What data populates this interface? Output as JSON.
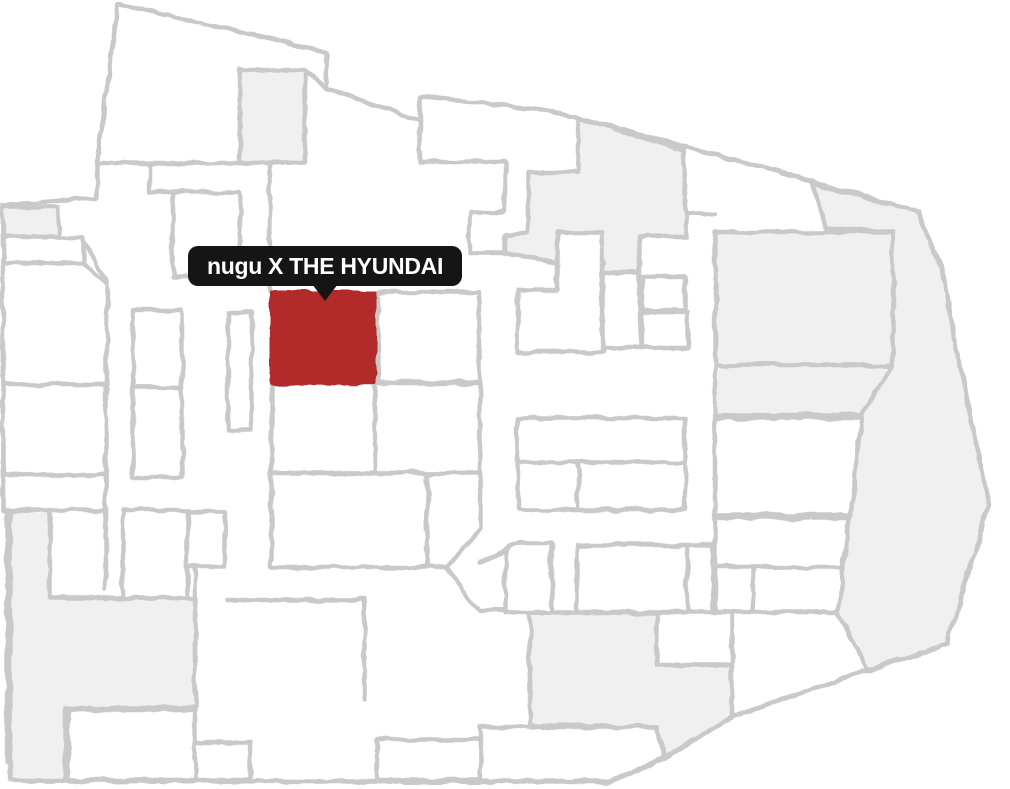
{
  "app": {
    "type": "indoor-floor-map",
    "description": "Department store floor map with one highlighted store"
  },
  "tooltip": {
    "label": "nugu X THE HYUNDAI",
    "bg": "#151515",
    "text_color": "#ffffff",
    "x": 188,
    "y": 246,
    "width": 274,
    "height": 40,
    "pointer_offset_x": 124
  },
  "colors": {
    "wall": "#c9c9c9",
    "room_fill": "#ffffff",
    "shaded_fill": "#f0f0f0",
    "highlight_fill": "#b22b2b",
    "background": "#ffffff"
  },
  "map": {
    "width": 1010,
    "height": 789,
    "stroke_width": 4.5,
    "highlight_room": {
      "label": "nugu X THE HYUNDAI",
      "x": 271,
      "y": 292,
      "width": 104,
      "height": 91
    },
    "shapes": [
      {
        "name": "outer-boundary",
        "kind": "boundary",
        "closed": true,
        "pts": "118,4 327,52 326,88 420,121 420,96 547,110 810,180 918,212 941,269 957,352 989,505 947,644 867,670 732,717 665,758 610,782 30,781 7,762 7,512 3,498 3,205 97,198 97,163"
      },
      {
        "name": "shaded-top-square",
        "kind": "shaded",
        "closed": true,
        "pts": "240,70 305,70 305,163 240,163"
      },
      {
        "name": "wall-top-connector",
        "kind": "wall",
        "closed": false,
        "pts": "305,70 325,87"
      },
      {
        "name": "shaded-left-small",
        "kind": "shaded",
        "closed": true,
        "pts": "3,207 58,207 58,237 3,237"
      },
      {
        "name": "shaded-top-middle",
        "kind": "shaded",
        "closed": true,
        "pts": "578,118 683,150 687,237 640,237 640,273 603,273 505,253 505,235 528,230 528,172 578,172"
      },
      {
        "name": "shaded-right-large",
        "kind": "shaded",
        "closed": true,
        "pts": "715,232 893,232 893,365 715,365"
      },
      {
        "name": "shaded-right-band",
        "kind": "shaded",
        "closed": true,
        "pts": "715,365 893,365 862,415 715,415"
      },
      {
        "name": "shaded-right-wing",
        "kind": "shaded",
        "closed": true,
        "pts": "812,183 918,212 941,269 957,352 989,505 947,644 867,670 838,613 845,520 862,415 893,365 893,232 826,228"
      },
      {
        "name": "shaded-bottom-left",
        "kind": "shaded",
        "closed": true,
        "pts": "10,510 50,510 50,598 195,598 195,708 65,708 65,781 10,781"
      },
      {
        "name": "shaded-bottom-middle",
        "kind": "shaded",
        "closed": true,
        "pts": "530,613 657,613 657,665 732,665 732,717 665,757 657,727 530,725"
      },
      {
        "name": "room-bottom-left-inner",
        "kind": "room",
        "closed": true,
        "pts": "68,710 195,710 195,780 68,780"
      },
      {
        "name": "room-bottom-left-small",
        "kind": "room",
        "closed": true,
        "pts": "195,742 250,742 250,780 195,780"
      },
      {
        "name": "room-center-l-shape",
        "kind": "room",
        "closed": true,
        "pts": "557,232 602,232 602,352 518,352 518,290 557,290"
      },
      {
        "name": "room-center-a",
        "kind": "room",
        "closed": true,
        "pts": "603,273 640,273 640,348 603,348"
      },
      {
        "name": "room-center-b",
        "kind": "room",
        "closed": true,
        "pts": "642,277 685,277 685,310 642,310"
      },
      {
        "name": "room-center-c",
        "kind": "room",
        "closed": true,
        "pts": "642,312 688,312 688,348 642,348"
      },
      {
        "name": "room-left-a",
        "kind": "room",
        "closed": true,
        "pts": "3,237 83,237 83,263 3,263"
      },
      {
        "name": "wall-left-funnel",
        "kind": "wall",
        "closed": false,
        "pts": "83,240 107,282"
      },
      {
        "name": "room-left-b",
        "kind": "room",
        "closed": true,
        "pts": "3,263 83,263 107,285 107,385 3,385"
      },
      {
        "name": "room-left-c",
        "kind": "room",
        "closed": true,
        "pts": "3,385 106,385 106,475 3,475"
      },
      {
        "name": "room-left-d",
        "kind": "room",
        "closed": true,
        "pts": "3,475 106,475 106,510 3,510"
      },
      {
        "name": "wall-left-corridor",
        "kind": "wall",
        "closed": false,
        "pts": "106,475 106,590"
      },
      {
        "name": "room-narrow-a",
        "kind": "room",
        "closed": true,
        "pts": "133,310 182,310 182,388 133,388"
      },
      {
        "name": "room-narrow-b",
        "kind": "room",
        "closed": true,
        "pts": "133,388 182,388 182,477 133,477"
      },
      {
        "name": "room-narrow-c",
        "kind": "room",
        "closed": true,
        "pts": "228,312 252,312 252,430 228,430"
      },
      {
        "name": "room-upper-center",
        "kind": "room",
        "closed": true,
        "pts": "173,192 240,192 240,277 173,277"
      },
      {
        "name": "wall-upper-step",
        "kind": "wall",
        "closed": false,
        "pts": "150,163 150,192 173,192"
      },
      {
        "name": "wall-topleft-bottom",
        "kind": "wall",
        "closed": false,
        "pts": "97,163 305,163"
      },
      {
        "name": "wall-corridor-v",
        "kind": "wall",
        "closed": false,
        "pts": "270,165 270,292"
      },
      {
        "name": "room-right-of-highlight",
        "kind": "room",
        "closed": true,
        "pts": "378,292 480,292 480,382 378,382"
      },
      {
        "name": "room-below-highlight-a",
        "kind": "room",
        "closed": true,
        "pts": "271,383 375,383 375,473 271,473"
      },
      {
        "name": "room-below-highlight-b",
        "kind": "room",
        "closed": true,
        "pts": "375,383 480,383 480,473 375,473"
      },
      {
        "name": "room-center-south-a",
        "kind": "room",
        "closed": true,
        "pts": "271,473 427,473 427,567 271,567"
      },
      {
        "name": "room-center-south-b",
        "kind": "room",
        "closed": true,
        "pts": "427,473 480,473 480,528 447,567 427,567"
      },
      {
        "name": "wall-diag-a",
        "kind": "wall",
        "closed": false,
        "pts": "447,567 468,599"
      },
      {
        "name": "wall-diag-b",
        "kind": "wall",
        "closed": false,
        "pts": "468,599 480,610 530,612"
      },
      {
        "name": "wall-diag-c",
        "kind": "wall",
        "closed": false,
        "pts": "480,563 520,543"
      },
      {
        "name": "wall-bottom-steps",
        "kind": "wall",
        "closed": false,
        "pts": "227,600 365,600 365,700"
      },
      {
        "name": "wall-mid-left",
        "kind": "wall",
        "closed": false,
        "pts": "195,567 195,598"
      },
      {
        "name": "room-left-e",
        "kind": "room",
        "closed": true,
        "pts": "123,510 187,510 187,598 123,598"
      },
      {
        "name": "room-left-f",
        "kind": "room",
        "closed": true,
        "pts": "187,512 225,512 225,567 187,567"
      },
      {
        "name": "wall-top-notch",
        "kind": "wall",
        "closed": false,
        "pts": "420,121 420,162 505,162 505,212 470,212 470,253 505,253"
      },
      {
        "name": "wall-corridor-top",
        "kind": "wall",
        "closed": false,
        "pts": "687,212 715,214"
      },
      {
        "name": "room-block-a",
        "kind": "room",
        "closed": true,
        "pts": "518,418 685,418 685,510 518,510"
      },
      {
        "name": "wall-block-a-h",
        "kind": "wall",
        "closed": false,
        "pts": "518,462 685,462"
      },
      {
        "name": "wall-block-a-v",
        "kind": "wall",
        "closed": false,
        "pts": "578,462 578,510"
      },
      {
        "name": "room-block-b",
        "kind": "room",
        "closed": true,
        "pts": "715,418 862,418 850,515 715,515"
      },
      {
        "name": "room-block-c",
        "kind": "room",
        "closed": true,
        "pts": "715,518 849,518 838,612 715,612"
      },
      {
        "name": "wall-block-c-h",
        "kind": "wall",
        "closed": false,
        "pts": "715,567 841,567"
      },
      {
        "name": "wall-block-c-v",
        "kind": "wall",
        "closed": false,
        "pts": "753,567 753,612"
      },
      {
        "name": "wall-block-c-r",
        "kind": "wall",
        "closed": false,
        "pts": "732,612 732,665"
      },
      {
        "name": "room-block-d",
        "kind": "room",
        "closed": true,
        "pts": "577,545 713,545 713,612 577,612"
      },
      {
        "name": "wall-block-d-v",
        "kind": "wall",
        "closed": false,
        "pts": "687,545 687,612"
      },
      {
        "name": "room-rounded-end",
        "kind": "path",
        "d": "M552,543 L552,613 L505,613 L505,560 Q505,543 523,543 Z"
      },
      {
        "name": "room-bottom-a",
        "kind": "room",
        "closed": true,
        "pts": "377,740 480,740 480,780 377,780"
      },
      {
        "name": "room-bottom-b",
        "kind": "room",
        "closed": true,
        "pts": "480,727 657,727 665,757 610,781 480,781"
      },
      {
        "name": "highlight-room-nugu",
        "kind": "highlight",
        "closed": true,
        "pts": "271,292 375,292 375,383 271,383"
      }
    ]
  }
}
